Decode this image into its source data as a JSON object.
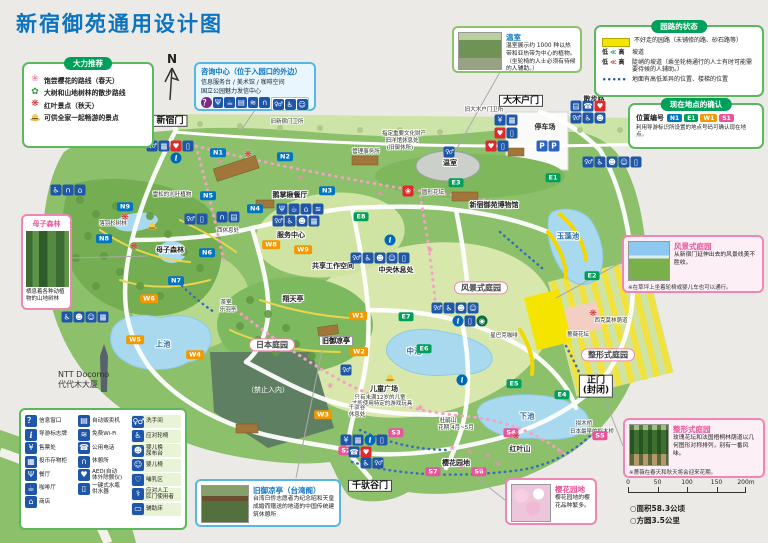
{
  "page": {
    "title": "新宿御苑通用设计图"
  },
  "compass": {
    "label": "N"
  },
  "recommend": {
    "title": "大力推荐",
    "items": [
      {
        "icon": "sakura",
        "label": "饱尝樱花的路线（春天）"
      },
      {
        "icon": "leaf",
        "label": "大树和山地树林的散步路线"
      },
      {
        "icon": "maple",
        "label": "红叶景点（秋天）"
      },
      {
        "icon": "hat",
        "label": "可供全家一起畅游的景点"
      }
    ]
  },
  "info_center": {
    "title": "咨询中心（位于入园口的外边）",
    "line1": "信息服务台 / 美术馆 / 咖啡空间",
    "line2": "国立公园魅力发信中心",
    "icons": [
      "question",
      "restaurant",
      "cafe",
      "vending",
      "wifi",
      "rest"
    ],
    "icons_grouped": [
      "toilet",
      "wheelchair",
      "babychair"
    ]
  },
  "path_status": {
    "title": "园路的状态",
    "items": [
      {
        "type": "yellow",
        "label": "不好走的园路（未铺修的路、砂石路等）"
      },
      {
        "type": "slope",
        "low": "低",
        "chev": "≪",
        "high": "高",
        "label": "坡道"
      },
      {
        "type": "steep",
        "low": "低",
        "chev": "≪",
        "high": "高",
        "label": "陡峭的坡道（乘坐轮椅通行的人士有时可能需要待候的人辅助。）"
      },
      {
        "type": "dots",
        "label": "地面有高低差异的位置、楼梯的位置"
      }
    ]
  },
  "location_check": {
    "title": "现在地点的确认",
    "caption": "位置编号",
    "badges": [
      {
        "text": "N1",
        "color": "#0075c2"
      },
      {
        "text": "E1",
        "color": "#00a05a"
      },
      {
        "text": "W1",
        "color": "#f39800"
      },
      {
        "text": "S1",
        "color": "#e8559a"
      }
    ],
    "note": "利用导游标识所设置的地点号码可确认现在地点。"
  },
  "callouts": {
    "greenhouse": {
      "title": "温室",
      "text": "温室展示约 1000 种以热带和亚热带为中心的植物。（坐轮椅的人士必须有待候的人辅助。）"
    },
    "landscape": {
      "title": "风景式庭园",
      "text": "从新宿门延伸出去的风景线美不胜收。",
      "note": "※在草坪上坐着轮椅或婴儿车也可以通行。"
    },
    "formal": {
      "title": "整形式庭园",
      "text": "玫瑰花坛和法国梧桐林荫道以几何图形对称排列，别有一番风味。",
      "note": "※蔷薇在春天和秋天将会迎来花期。"
    },
    "mother": {
      "title": "母子森林",
      "text": "栖息着各种动植物的山地树林"
    },
    "pavilion": {
      "title": "旧御凉亭（台湾阁）",
      "text": "台湾日侨志愿者为纪念昭和天皇成婚而赠送的地道的中国传统建筑休憩所"
    },
    "cherry": {
      "title": "樱花园地",
      "text": "樱花园地的樱花品种繁多。"
    }
  },
  "facility_legend": {
    "columns": [
      [
        {
          "icon": "question",
          "label": "信息窗口"
        },
        {
          "icon": "info",
          "label": "导游标志牌"
        },
        {
          "icon": "ticket",
          "label": "售票处"
        },
        {
          "icon": "locker",
          "label": "投币存物柜"
        },
        {
          "icon": "restaurant",
          "label": "餐厅"
        },
        {
          "icon": "cafe",
          "label": "咖啡厅"
        },
        {
          "icon": "shop",
          "label": "商店"
        }
      ],
      [
        {
          "icon": "vending",
          "label": "自动贩卖机"
        },
        {
          "icon": "wifi",
          "label": "免费Wi-Fi"
        },
        {
          "icon": "phone",
          "label": "公用电话"
        },
        {
          "icon": "rest",
          "label": "休憩所"
        },
        {
          "icon": "aed",
          "label": "AED(自动\n体外除颤仪)"
        },
        {
          "icon": "water",
          "label": "一键式水瓶\n供水器"
        }
      ],
      [
        {
          "icon": "toilet",
          "label": "洗手间",
          "chip": true
        },
        {
          "icon": "wheelchair",
          "label": "应对轮椅",
          "chip": true
        },
        {
          "icon": "diaper",
          "label": "婴儿换\n尿布台",
          "chip": true
        },
        {
          "icon": "babychair",
          "label": "婴儿椅",
          "chip": true
        },
        {
          "icon": "nursing",
          "label": "哺乳区",
          "chip": true
        },
        {
          "icon": "ostomy",
          "label": "应对人工\n肛门使用者",
          "chip": true
        },
        {
          "icon": "bed",
          "label": "辅助床",
          "chip": true
        }
      ]
    ]
  },
  "scalebar": {
    "ticks": [
      "0",
      "50",
      "100",
      "150",
      "200m"
    ]
  },
  "stats": {
    "area": "○面积58.3公顷",
    "perimeter": "○方圆3.5公里"
  },
  "ntt": {
    "line1": "NTT Docomo",
    "line2": "代代木大厦"
  },
  "map": {
    "marker_colors": {
      "N": "#0075c2",
      "E": "#00a05a",
      "W": "#f39800",
      "S": "#e8559a"
    },
    "gates": [
      {
        "lines": [
          "新宿门"
        ],
        "x": 170,
        "y": 121
      },
      {
        "lines": [
          "大木户门"
        ],
        "x": 521,
        "y": 101
      },
      {
        "lines": [
          "千驮谷门"
        ],
        "x": 370,
        "y": 486
      },
      {
        "lines": [
          "正门",
          "(封闭)"
        ],
        "x": 596,
        "y": 386
      }
    ],
    "pills": [
      {
        "t": "日本庭园",
        "x": 272,
        "y": 345
      },
      {
        "t": "风景式庭园",
        "x": 481,
        "y": 288
      },
      {
        "t": "整形式庭园",
        "x": 608,
        "y": 355
      }
    ],
    "labels": [
      {
        "t": "旧新宿门卫所",
        "x": 287,
        "y": 122,
        "c": "vs"
      },
      {
        "t": "管理事务所",
        "x": 366,
        "y": 152,
        "c": "vs"
      },
      {
        "t": "指定重要文化财产",
        "x": 404,
        "y": 134,
        "c": "vs"
      },
      {
        "t": "旧洋馆休息处",
        "x": 402,
        "y": 141,
        "c": "vs"
      },
      {
        "t": "(旧御休所)",
        "x": 400,
        "y": 148,
        "c": "vs"
      },
      {
        "t": "旧大木户门卫所",
        "x": 484,
        "y": 110,
        "c": "vs"
      },
      {
        "t": "散步路",
        "x": 594,
        "y": 99,
        "c": "sm"
      },
      {
        "t": "停车场",
        "x": 545,
        "y": 127,
        "c": "sm"
      },
      {
        "t": "温室",
        "x": 450,
        "y": 163,
        "c": "sm"
      },
      {
        "t": "圆形花坛",
        "x": 433,
        "y": 193,
        "c": "vs"
      },
      {
        "t": "鹅掌楸餐厅",
        "x": 290,
        "y": 195,
        "c": "sm"
      },
      {
        "t": "新宿御苑博物馆",
        "x": 494,
        "y": 205,
        "c": "sm"
      },
      {
        "t": "玉藻池",
        "x": 568,
        "y": 237,
        "c": "pond"
      },
      {
        "t": "雪松的刈叶植物",
        "x": 172,
        "y": 195,
        "c": "vs"
      },
      {
        "t": "落羽杉树林",
        "x": 113,
        "y": 224,
        "c": "vs"
      },
      {
        "t": "母子森林",
        "x": 170,
        "y": 250,
        "c": "sm"
      },
      {
        "t": "西休息处",
        "x": 228,
        "y": 231,
        "c": "vs"
      },
      {
        "t": "服务中心",
        "x": 291,
        "y": 235,
        "c": "sm"
      },
      {
        "t": "中央休息处",
        "x": 396,
        "y": 270,
        "c": "sm"
      },
      {
        "t": "共享工作空间",
        "x": 333,
        "y": 266,
        "c": "sm"
      },
      {
        "t": "翔天亭",
        "x": 293,
        "y": 299,
        "c": "sm"
      },
      {
        "t": "茶室",
        "x": 226,
        "y": 303,
        "c": "vs"
      },
      {
        "t": "乐羽亭",
        "x": 228,
        "y": 310,
        "c": "vs"
      },
      {
        "t": "上池",
        "x": 163,
        "y": 345,
        "c": "pond"
      },
      {
        "t": "中池",
        "x": 414,
        "y": 352,
        "c": "pond"
      },
      {
        "t": "下池",
        "x": 527,
        "y": 417,
        "c": "pond"
      },
      {
        "t": "（禁止入内）",
        "x": 268,
        "y": 390,
        "c": "dark"
      },
      {
        "t": "儿童广场",
        "x": 384,
        "y": 389,
        "c": "sm"
      },
      {
        "t": "只有未满12岁的儿童",
        "x": 380,
        "y": 398,
        "c": "vs"
      },
      {
        "t": "才能使用特定的游戏玩具",
        "x": 382,
        "y": 404,
        "c": "vs"
      },
      {
        "t": "千驮谷",
        "x": 357,
        "y": 408,
        "c": "vs"
      },
      {
        "t": "休息处",
        "x": 357,
        "y": 415,
        "c": "vs"
      },
      {
        "t": "杜鹃山",
        "x": 448,
        "y": 421,
        "c": "vs"
      },
      {
        "t": "花期:4月~5月",
        "x": 456,
        "y": 428,
        "c": "vs"
      },
      {
        "t": "红叶山",
        "x": 520,
        "y": 449,
        "c": "sm"
      },
      {
        "t": "拟木桥",
        "x": 584,
        "y": 424,
        "c": "vs"
      },
      {
        "t": "日本最早的拟木桥",
        "x": 592,
        "y": 432,
        "c": "vs"
      },
      {
        "t": "蔷薇花坛",
        "x": 578,
        "y": 335,
        "c": "vs"
      },
      {
        "t": "西克莫林荫道",
        "x": 611,
        "y": 321,
        "c": "vs"
      },
      {
        "t": "星巴克咖啡",
        "x": 504,
        "y": 336,
        "c": "vs"
      },
      {
        "t": "樱花园地",
        "x": 456,
        "y": 463,
        "c": "sm"
      },
      {
        "t": "旧御凉亭",
        "x": 336,
        "y": 341,
        "c": "boxed"
      }
    ],
    "markers": [
      {
        "id": "N1",
        "x": 218,
        "y": 153
      },
      {
        "id": "N2",
        "x": 285,
        "y": 157
      },
      {
        "id": "N3",
        "x": 327,
        "y": 191
      },
      {
        "id": "N4",
        "x": 255,
        "y": 209
      },
      {
        "id": "N5",
        "x": 208,
        "y": 196
      },
      {
        "id": "N6",
        "x": 207,
        "y": 253
      },
      {
        "id": "N7",
        "x": 176,
        "y": 281
      },
      {
        "id": "N8",
        "x": 104,
        "y": 239
      },
      {
        "id": "N9",
        "x": 125,
        "y": 207
      },
      {
        "id": "E1",
        "x": 553,
        "y": 178
      },
      {
        "id": "E2",
        "x": 592,
        "y": 276
      },
      {
        "id": "E3",
        "x": 456,
        "y": 183
      },
      {
        "id": "E4",
        "x": 562,
        "y": 395
      },
      {
        "id": "E5",
        "x": 514,
        "y": 384
      },
      {
        "id": "E6",
        "x": 424,
        "y": 349
      },
      {
        "id": "E7",
        "x": 406,
        "y": 317
      },
      {
        "id": "E8",
        "x": 361,
        "y": 217
      },
      {
        "id": "W1",
        "x": 358,
        "y": 316
      },
      {
        "id": "W2",
        "x": 359,
        "y": 352
      },
      {
        "id": "W3",
        "x": 323,
        "y": 415
      },
      {
        "id": "W4",
        "x": 195,
        "y": 355
      },
      {
        "id": "W5",
        "x": 135,
        "y": 340
      },
      {
        "id": "W6",
        "x": 149,
        "y": 299
      },
      {
        "id": "W8",
        "x": 271,
        "y": 245
      },
      {
        "id": "W9",
        "x": 303,
        "y": 250
      },
      {
        "id": "S2",
        "x": 346,
        "y": 451
      },
      {
        "id": "S3",
        "x": 396,
        "y": 433
      },
      {
        "id": "S4",
        "x": 511,
        "y": 433
      },
      {
        "id": "S5",
        "x": 600,
        "y": 436
      },
      {
        "id": "S6",
        "x": 479,
        "y": 472
      },
      {
        "id": "S7",
        "x": 433,
        "y": 472
      }
    ],
    "clusters": [
      {
        "x": 170,
        "y": 146,
        "icons": [
          "toilet",
          "locker",
          "aed",
          "water"
        ]
      },
      {
        "x": 68,
        "y": 190,
        "icons": [
          "wheelchair",
          "rest",
          "shop"
        ]
      },
      {
        "x": 300,
        "y": 209,
        "icons": [
          "restaurant",
          "cafe",
          "shop",
          "wifi"
        ]
      },
      {
        "x": 296,
        "y": 221,
        "icons": [
          "toilet",
          "wheelchair",
          "diaper",
          "locker"
        ]
      },
      {
        "x": 228,
        "y": 217,
        "icons": [
          "rest",
          "vending"
        ]
      },
      {
        "x": 449,
        "y": 152,
        "icons": [
          "toilet"
        ]
      },
      {
        "x": 497,
        "y": 146,
        "icons": [
          "aed",
          "water"
        ]
      },
      {
        "x": 506,
        "y": 120,
        "icons": [
          "ticket",
          "locker"
        ]
      },
      {
        "x": 506,
        "y": 133,
        "icons": [
          "aed",
          "water"
        ]
      },
      {
        "x": 548,
        "y": 146,
        "icons": [
          "parking",
          "parking"
        ]
      },
      {
        "x": 588,
        "y": 106,
        "icons": [
          "vending",
          "phone",
          "aed"
        ]
      },
      {
        "x": 588,
        "y": 118,
        "icons": [
          "toilet",
          "wheelchair",
          "diaper"
        ]
      },
      {
        "x": 612,
        "y": 162,
        "icons": [
          "toilet",
          "wheelchair",
          "diaper",
          "babychair",
          "water"
        ]
      },
      {
        "x": 380,
        "y": 258,
        "icons": [
          "toilet",
          "wheelchair",
          "diaper",
          "babychair",
          "water"
        ]
      },
      {
        "x": 455,
        "y": 308,
        "icons": [
          "toilet",
          "wheelchair",
          "diaper",
          "babychair"
        ]
      },
      {
        "x": 470,
        "y": 321,
        "icons": [
          "info",
          "water",
          "starbucks"
        ]
      },
      {
        "x": 346,
        "y": 370,
        "icons": [
          "toilet"
        ]
      },
      {
        "x": 196,
        "y": 219,
        "icons": [
          "toilet",
          "water"
        ]
      },
      {
        "x": 85,
        "y": 317,
        "icons": [
          "wheelchair",
          "diaper",
          "babychair",
          "locker"
        ]
      },
      {
        "x": 364,
        "y": 440,
        "icons": [
          "ticket",
          "locker",
          "info",
          "water"
        ]
      },
      {
        "x": 360,
        "y": 452,
        "icons": [
          "phone",
          "aed"
        ]
      },
      {
        "x": 372,
        "y": 463,
        "icons": [
          "wheelchair",
          "toilet"
        ]
      },
      {
        "x": 408,
        "y": 191,
        "icons": [
          "flowerbed"
        ]
      },
      {
        "x": 176,
        "y": 158,
        "icons": [
          "info"
        ]
      },
      {
        "x": 390,
        "y": 240,
        "icons": [
          "info"
        ]
      },
      {
        "x": 462,
        "y": 380,
        "icons": [
          "info"
        ]
      }
    ],
    "stars": [
      [
        125,
        218
      ],
      [
        134,
        247
      ],
      [
        248,
        155
      ],
      [
        593,
        314
      ],
      [
        516,
        437
      ]
    ],
    "hats": [
      [
        152,
        226
      ],
      [
        390,
        378
      ]
    ],
    "flowers": [
      [
        220,
        162
      ],
      [
        300,
        178
      ],
      [
        380,
        194
      ],
      [
        246,
        318
      ],
      [
        330,
        386
      ],
      [
        420,
        408
      ],
      [
        560,
        452
      ],
      [
        430,
        250
      ],
      [
        452,
        448
      ],
      [
        470,
        452
      ],
      [
        488,
        456
      ],
      [
        462,
        468
      ],
      [
        480,
        470
      ],
      [
        498,
        464
      ]
    ]
  },
  "icon_glyphs": {
    "question": "？",
    "info": "i",
    "ticket": "¥",
    "locker": "▦",
    "restaurant": "Ψ",
    "cafe": "☕",
    "shop": "⌂",
    "vending": "▤",
    "wifi": "≋",
    "phone": "☎",
    "rest": "∩",
    "aed": "♥",
    "water": "▯",
    "toilet": "♀♂",
    "wheelchair": "♿",
    "diaper": "☻",
    "babychair": "☺",
    "nursing": "♡",
    "ostomy": "⚕",
    "bed": "▭",
    "parking": "P",
    "starbucks": "◉",
    "flowerbed": "❀",
    "dots": "•••••",
    "sakura": "❀",
    "leaf": "✿",
    "maple": "❋"
  }
}
